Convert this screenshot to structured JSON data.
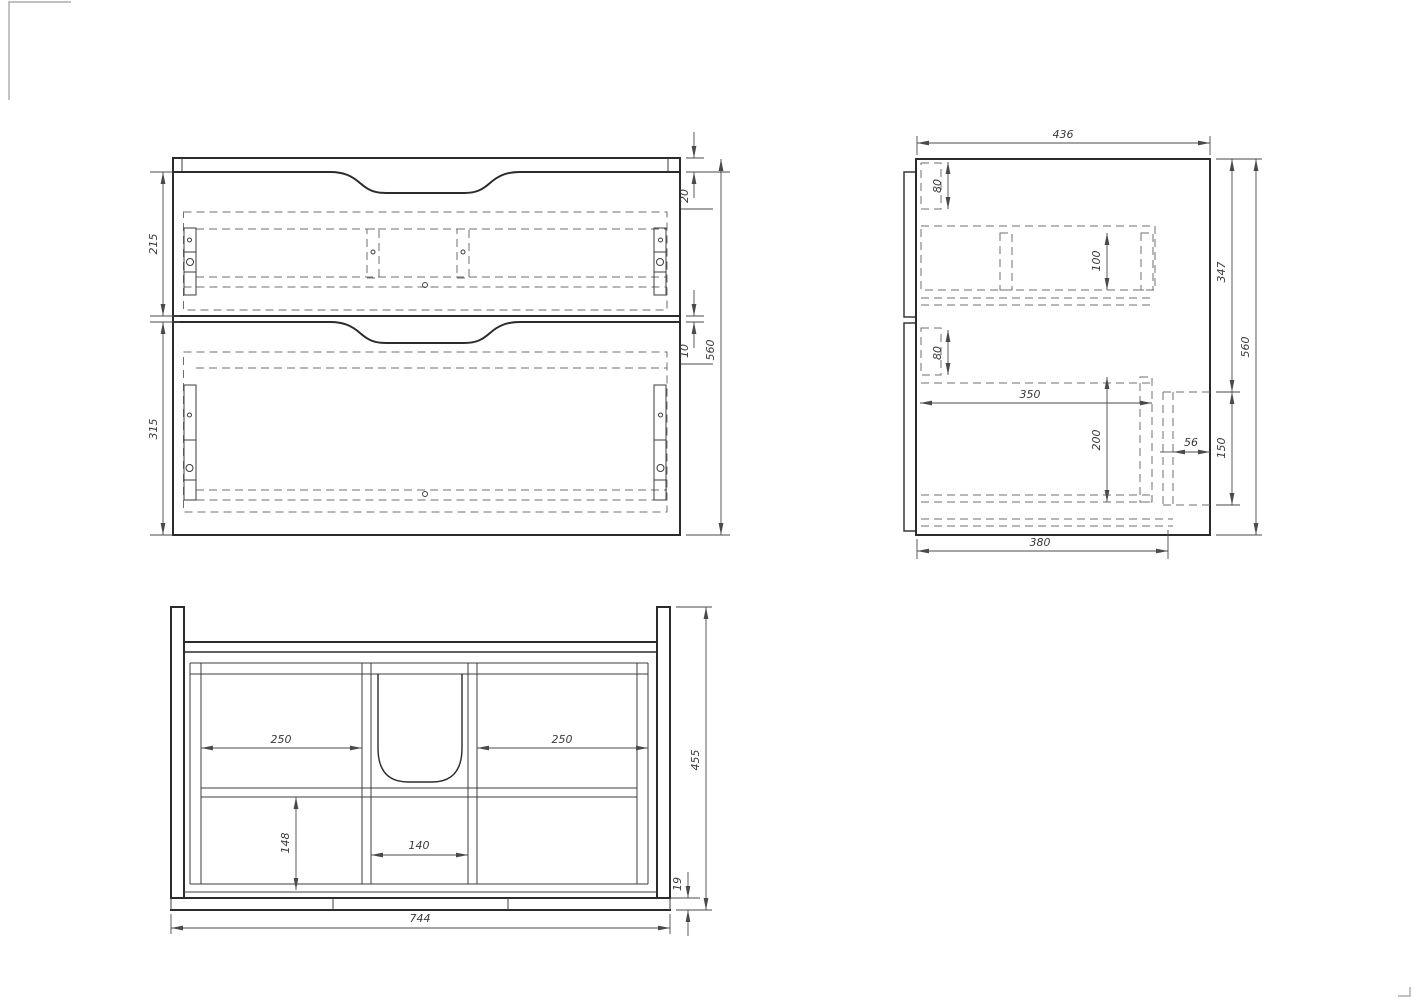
{
  "sheet": {
    "background": "#ffffff",
    "object_line_color": "#2b2b2b",
    "hidden_line_color": "#6f6f6f",
    "dimension_color": "#3a3a3a"
  },
  "views": {
    "front": {
      "label": "front-view",
      "dims": {
        "drawer_top_height": "215",
        "drawer_bottom_height": "315",
        "top_overhang": "20",
        "drawer_gap": "10",
        "overall_height": "560"
      }
    },
    "side": {
      "label": "side-view",
      "dims": {
        "overall_depth": "436",
        "slide_offset_upper": "80",
        "slide_width_upper": "100",
        "slide_offset_lower": "80",
        "slide_span_lower": "350",
        "slide_width_lower": "200",
        "back_cutout_depth": "56",
        "back_cutout_height": "150",
        "top_to_cutout": "347",
        "overall_height": "560",
        "bottom_panel_depth": "380"
      }
    },
    "plan": {
      "label": "top-view",
      "dims": {
        "left_bay_width": "250",
        "right_bay_width": "250",
        "center_bay_width": "140",
        "front_bay_depth": "148",
        "overall_depth": "455",
        "bottom_rail_thickness": "19",
        "overall_width": "744"
      }
    }
  }
}
